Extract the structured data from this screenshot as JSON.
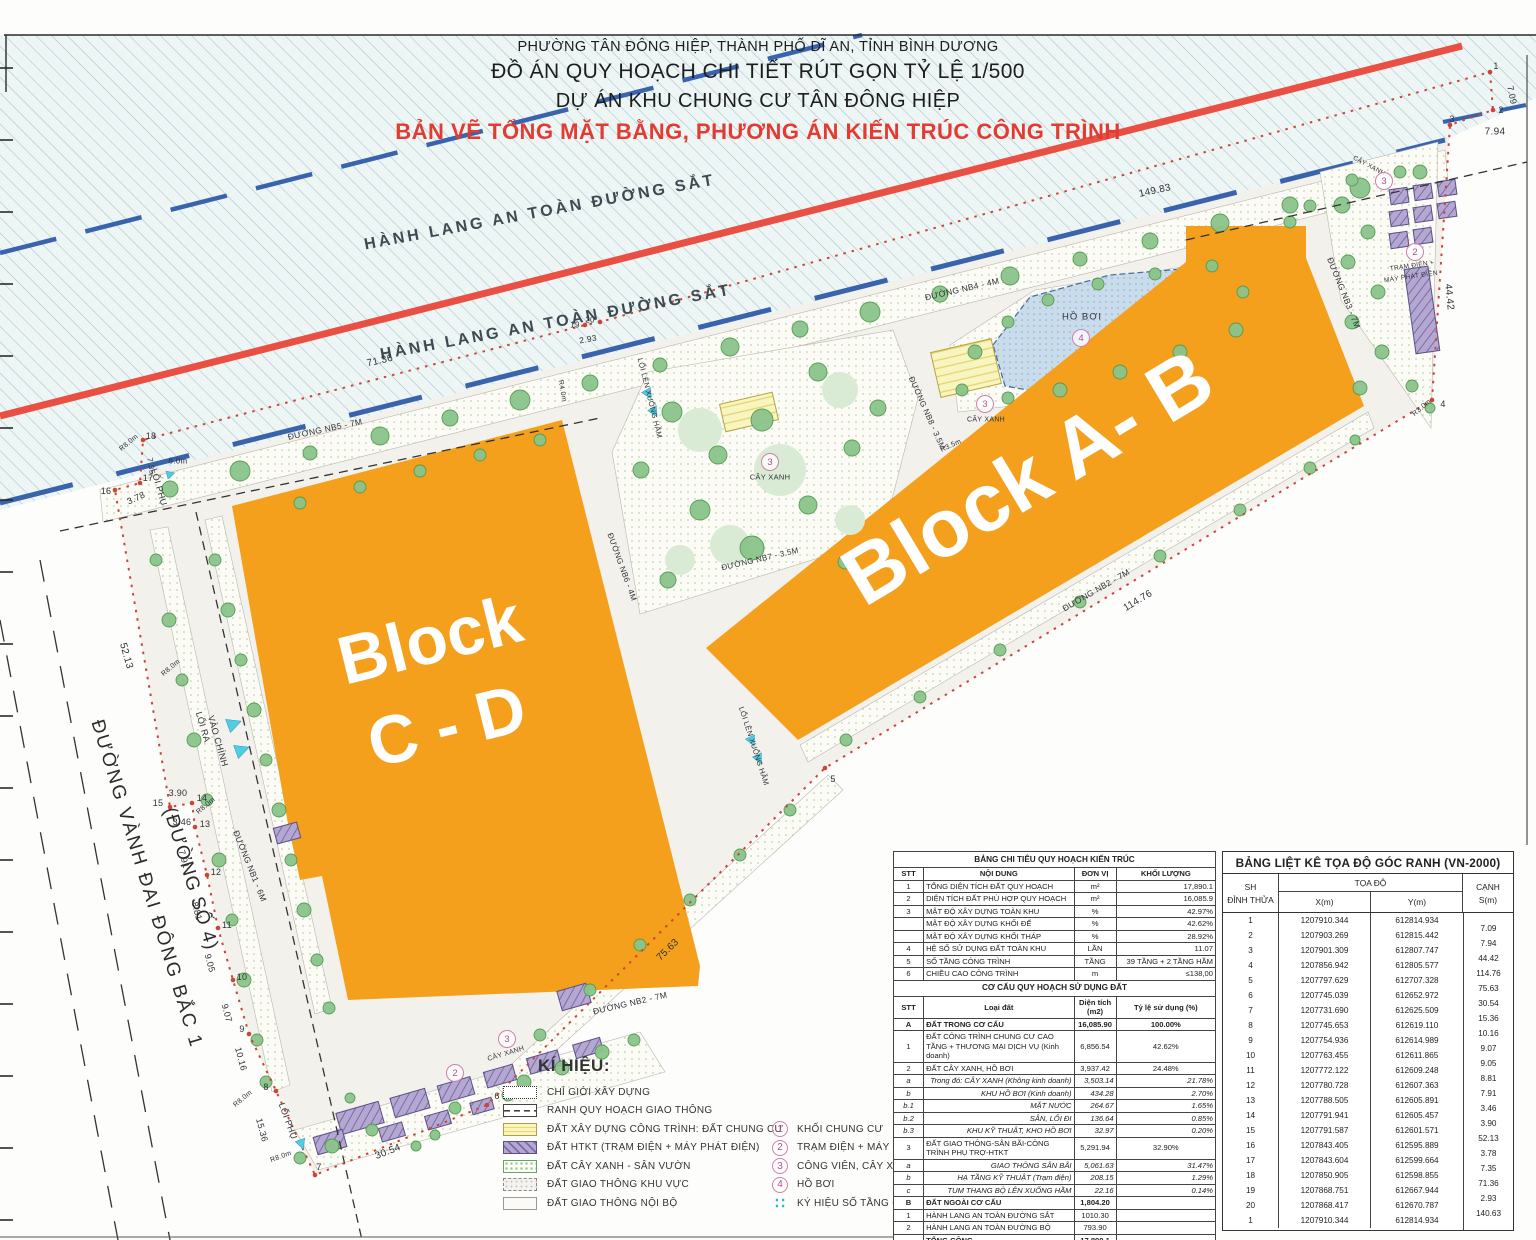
{
  "title": {
    "l1": "PHƯỜNG TÂN ĐÔNG HIỆP, THÀNH PHỐ DĨ AN, TỈNH BÌNH DƯƠNG",
    "l2": "ĐỒ ÁN QUY HOẠCH CHI TIẾT RÚT GỌN TỶ LỆ 1/500",
    "l3": "DỰ ÁN KHU CHUNG CƯ TÂN ĐÔNG HIỆP",
    "l4": "BẢN VẼ TỔNG MẶT BẰNG, PHƯƠNG ÁN KIẾN TRÚC CÔNG TRÌNH"
  },
  "colors": {
    "block_orange": "#F5A01D",
    "railway_red_line": "#E94F43",
    "corridor_blue_dash": "#3A63AE",
    "boundary_red": "#CC4437",
    "pool_blue": "#C6D9EA",
    "htkt_purple": "#A393C6",
    "building_yellow": "#F7F3BB",
    "tree_green": "#86C586",
    "symbol_pink": "#B0509A",
    "arrow_cyan": "#53CBE2",
    "title_red": "#E23B31"
  },
  "plan": {
    "labels": [
      {
        "t": "HÀNH LANG AN TOÀN ĐƯỜNG SẮT",
        "x": 540,
        "y": 213,
        "r": -10.5,
        "s": 16,
        "ls": 3,
        "c": "#3d4a52",
        "w": 600
      },
      {
        "t": "HÀNH LANG AN TOÀN ĐƯỜNG SẮT",
        "x": 556,
        "y": 323,
        "r": -10.5,
        "s": 16,
        "ls": 3,
        "c": "#3d4a52",
        "w": 600
      },
      {
        "t": "Block",
        "x": 430,
        "y": 640,
        "r": -14,
        "s": 68,
        "w": 700,
        "c": "#ffffff"
      },
      {
        "t": "C - D",
        "x": 447,
        "y": 726,
        "r": -14,
        "s": 68,
        "w": 700,
        "c": "#ffffff"
      },
      {
        "t": "Block A- B",
        "x": 1028,
        "y": 478,
        "r": -31,
        "s": 82,
        "w": 700,
        "c": "#ffffff"
      },
      {
        "t": "ĐƯỜNG VÀNH ĐAI ĐÔNG BẮC 1",
        "x": 146,
        "y": 884,
        "r": 73,
        "s": 19,
        "ls": 2,
        "c": "#2c2c2c"
      },
      {
        "t": "(ĐƯỜNG SỐ 4)",
        "x": 190,
        "y": 879,
        "r": 73,
        "s": 19,
        "ls": 1,
        "c": "#2c2c2c"
      },
      {
        "t": "ĐƯỜNG NB5 - 7M",
        "x": 325,
        "y": 429,
        "r": -12,
        "s": 8.5
      },
      {
        "t": "ĐƯỜNG NB4 - 4M",
        "x": 962,
        "y": 289,
        "r": -13,
        "s": 8.5
      },
      {
        "t": "ĐƯỜNG NB3 - 7M",
        "x": 1344,
        "y": 293,
        "r": 68,
        "s": 8.5
      },
      {
        "t": "ĐƯỜNG NB2 - 7M",
        "x": 1096,
        "y": 590,
        "r": -30,
        "s": 8.5
      },
      {
        "t": "ĐƯỜNG NB2 - 7M",
        "x": 630,
        "y": 1003,
        "r": -13,
        "s": 8.5
      },
      {
        "t": "ĐƯỜNG NB1 - 6M",
        "x": 250,
        "y": 866,
        "r": 68,
        "s": 8.5
      },
      {
        "t": "ĐƯỜNG NB8 - 3.5M",
        "x": 927,
        "y": 413,
        "r": 66,
        "s": 8
      },
      {
        "t": "ĐƯỜNG NB7 - 3.5M",
        "x": 760,
        "y": 559,
        "r": -13,
        "s": 8
      },
      {
        "t": "ĐƯỜNG NB6 - 4M",
        "x": 622,
        "y": 567,
        "r": 70,
        "s": 8
      },
      {
        "t": "LỐI RA",
        "x": 203,
        "y": 727,
        "r": 74,
        "s": 9
      },
      {
        "t": "VÀO CHÍNH",
        "x": 218,
        "y": 741,
        "r": 74,
        "s": 9
      },
      {
        "t": "LỐI PHỤ",
        "x": 159,
        "y": 487,
        "r": 74,
        "s": 9
      },
      {
        "t": "LỐI PHỤ",
        "x": 288,
        "y": 1121,
        "r": 70,
        "s": 9
      },
      {
        "t": "LỐI LÊN XUỐNG HẦM",
        "x": 650,
        "y": 398,
        "r": 76,
        "s": 7.5
      },
      {
        "t": "LỐI LÊN XUỐNG HẦM",
        "x": 754,
        "y": 746,
        "r": 72,
        "s": 7.5
      },
      {
        "t": "HỒ BƠI",
        "x": 1082,
        "y": 317,
        "r": 0,
        "s": 9.5,
        "ls": 1
      },
      {
        "t": "CÂY XANH",
        "x": 770,
        "y": 477,
        "r": 0,
        "s": 7.5
      },
      {
        "t": "CÂY XANH",
        "x": 986,
        "y": 420,
        "r": 0,
        "s": 7
      },
      {
        "t": "CÂY XANH",
        "x": 1369,
        "y": 166,
        "r": 28,
        "s": 6.5
      },
      {
        "t": "CÂY XANH",
        "x": 506,
        "y": 1054,
        "r": -17,
        "s": 7
      },
      {
        "t": "TRẠM ĐIỆN +",
        "x": 1412,
        "y": 266,
        "r": -8,
        "s": 6.5
      },
      {
        "t": "MÁY PHÁT ĐIỆN",
        "x": 1411,
        "y": 277,
        "r": -8,
        "s": 6.5
      },
      {
        "t": "149.83",
        "x": 1155,
        "y": 191,
        "r": -12,
        "s": 10
      },
      {
        "t": "7.94",
        "x": 1495,
        "y": 132,
        "r": 0,
        "s": 10
      },
      {
        "t": "7.09",
        "x": 1512,
        "y": 95,
        "r": 78,
        "s": 9
      },
      {
        "t": "44.42",
        "x": 1449,
        "y": 297,
        "r": 84,
        "s": 10
      },
      {
        "t": "114.76",
        "x": 1138,
        "y": 601,
        "r": -31,
        "s": 10
      },
      {
        "t": "75.63",
        "x": 668,
        "y": 950,
        "r": -44,
        "s": 10
      },
      {
        "t": "30.54",
        "x": 388,
        "y": 1152,
        "r": -21,
        "s": 10
      },
      {
        "t": "52.13",
        "x": 126,
        "y": 656,
        "r": 74,
        "s": 10
      },
      {
        "t": "71.36",
        "x": 380,
        "y": 361,
        "r": -13,
        "s": 10
      },
      {
        "t": "2.93",
        "x": 588,
        "y": 339,
        "r": -10,
        "s": 8.5
      },
      {
        "t": "3.78",
        "x": 136,
        "y": 498,
        "r": -25,
        "s": 9
      },
      {
        "t": "7.35",
        "x": 151,
        "y": 466,
        "r": 80,
        "s": 8
      },
      {
        "t": "6.0m",
        "x": 178,
        "y": 461,
        "r": 0,
        "s": 8
      },
      {
        "t": "3.90",
        "x": 178,
        "y": 793,
        "r": 0,
        "s": 9
      },
      {
        "t": "3.46",
        "x": 182,
        "y": 822,
        "r": 0,
        "s": 9
      },
      {
        "t": "7.91",
        "x": 184,
        "y": 859,
        "r": 75,
        "s": 9
      },
      {
        "t": "8.81",
        "x": 197,
        "y": 911,
        "r": 75,
        "s": 9
      },
      {
        "t": "9.05",
        "x": 210,
        "y": 963,
        "r": 75,
        "s": 9
      },
      {
        "t": "9.07",
        "x": 227,
        "y": 1013,
        "r": 75,
        "s": 9
      },
      {
        "t": "10.16",
        "x": 241,
        "y": 1059,
        "r": 75,
        "s": 9
      },
      {
        "t": "15.36",
        "x": 262,
        "y": 1130,
        "r": 75,
        "s": 9
      },
      {
        "t": "R8.0m",
        "x": 129,
        "y": 443,
        "r": -40,
        "s": 7
      },
      {
        "t": "R8.0m",
        "x": 171,
        "y": 668,
        "r": -40,
        "s": 7
      },
      {
        "t": "R8.0m",
        "x": 206,
        "y": 806,
        "r": -40,
        "s": 7
      },
      {
        "t": "R8.0m",
        "x": 243,
        "y": 1099,
        "r": -40,
        "s": 7
      },
      {
        "t": "R8.0m",
        "x": 281,
        "y": 1157,
        "r": -20,
        "s": 7
      },
      {
        "t": "R4.0m",
        "x": 562,
        "y": 391,
        "r": 80,
        "s": 7
      },
      {
        "t": "R3.5m",
        "x": 951,
        "y": 446,
        "r": -25,
        "s": 7
      },
      {
        "t": "R3.0m",
        "x": 1422,
        "y": 408,
        "r": -40,
        "s": 7
      },
      {
        "t": "1",
        "x": 1496,
        "y": 66,
        "r": 0,
        "s": 9
      },
      {
        "t": "2",
        "x": 1501,
        "y": 110,
        "r": 0,
        "s": 9
      },
      {
        "t": "3",
        "x": 1452,
        "y": 119,
        "r": 0,
        "s": 9
      },
      {
        "t": "4",
        "x": 1443,
        "y": 404,
        "r": 0,
        "s": 9
      },
      {
        "t": "5",
        "x": 833,
        "y": 779,
        "r": 0,
        "s": 9
      },
      {
        "t": "6",
        "x": 497,
        "y": 1096,
        "r": 0,
        "s": 9
      },
      {
        "t": "7",
        "x": 319,
        "y": 1167,
        "r": 0,
        "s": 9
      },
      {
        "t": "8",
        "x": 266,
        "y": 1087,
        "r": 0,
        "s": 9
      },
      {
        "t": "9",
        "x": 242,
        "y": 1029,
        "r": 0,
        "s": 9
      },
      {
        "t": "10",
        "x": 242,
        "y": 977,
        "r": 0,
        "s": 9
      },
      {
        "t": "11",
        "x": 227,
        "y": 925,
        "r": 0,
        "s": 9
      },
      {
        "t": "12",
        "x": 216,
        "y": 872,
        "r": 0,
        "s": 9
      },
      {
        "t": "13",
        "x": 205,
        "y": 824,
        "r": 0,
        "s": 9
      },
      {
        "t": "14",
        "x": 202,
        "y": 798,
        "r": 0,
        "s": 9
      },
      {
        "t": "15",
        "x": 158,
        "y": 803,
        "r": 0,
        "s": 9
      },
      {
        "t": "16",
        "x": 106,
        "y": 491,
        "r": 0,
        "s": 9
      },
      {
        "t": "17",
        "x": 148,
        "y": 478,
        "r": 0,
        "s": 9
      },
      {
        "t": "18",
        "x": 151,
        "y": 436,
        "r": 0,
        "s": 9
      },
      {
        "t": "19",
        "x": 575,
        "y": 325,
        "r": 0,
        "s": 8
      },
      {
        "t": "20",
        "x": 590,
        "y": 320,
        "r": 0,
        "s": 8
      }
    ],
    "circles": [
      {
        "n": "4",
        "x": 1081,
        "y": 338
      },
      {
        "n": "3",
        "x": 770,
        "y": 462
      },
      {
        "n": "3",
        "x": 985,
        "y": 404
      },
      {
        "n": "3",
        "x": 1384,
        "y": 181
      },
      {
        "n": "3",
        "x": 507,
        "y": 1039
      },
      {
        "n": "2",
        "x": 1415,
        "y": 252
      },
      {
        "n": "2",
        "x": 455,
        "y": 1073
      }
    ]
  },
  "legend": {
    "title": "KÍ HIỆU:",
    "left": [
      {
        "key": "dotted",
        "label": "CHỈ GIỚI XÂY DỰNG"
      },
      {
        "key": "dash",
        "label": "RANH QUY HOẠCH GIAO THÔNG"
      },
      {
        "key": "yellow",
        "label": "ĐẤT XÂY DỰNG CÔNG TRÌNH: ĐẤT CHUNG CƯ"
      },
      {
        "key": "purple",
        "label": "ĐẤT HTKT (TRẠM ĐIỆN + MÁY PHÁT ĐIỆN)"
      },
      {
        "key": "green",
        "label": "ĐẤT CÂY XANH - SÂN VƯỜN"
      },
      {
        "key": "road1",
        "label": "ĐẤT GIAO THÔNG KHU VỰC"
      },
      {
        "key": "road2",
        "label": "ĐẤT GIAO THÔNG NỘI BỘ"
      }
    ],
    "right": [
      {
        "sym": "1",
        "type": "circle",
        "label": "KHỐI CHUNG CƯ"
      },
      {
        "sym": "2",
        "type": "circle",
        "label": "TRẠM ĐIỆN + MÁY PHÁT ĐIỆN"
      },
      {
        "sym": "3",
        "type": "circle",
        "label": "CÔNG VIÊN, CÂY XANH"
      },
      {
        "sym": "4",
        "type": "circle",
        "label": "HỒ BƠI"
      },
      {
        "sym": "∷",
        "type": "dots",
        "label": "KÝ HIỆU SỐ TẦNG CAO"
      }
    ]
  },
  "tables": {
    "chitieu": {
      "title": "BẢNG CHI TIÊU QUY HOẠCH KIẾN TRÚC",
      "head": [
        "STT",
        "NỘI DUNG",
        "ĐƠN VỊ",
        "KHỐI LƯỢNG"
      ],
      "rows": [
        {
          "stt": "1",
          "c2": "TỔNG DIỆN TÍCH ĐẤT QUY HOẠCH",
          "c3": "m²",
          "c4": "17,890.1"
        },
        {
          "stt": "2",
          "c2": "DIỆN TÍCH ĐẤT PHÙ HỢP QUY HOẠCH",
          "c3": "m²",
          "c4": "16,085.9"
        },
        {
          "stt": "3",
          "c2": "MẬT ĐỘ XÂY DỰNG TOÀN KHU",
          "c3": "%",
          "c4": "42.97%"
        },
        {
          "stt": "",
          "c2": "MẬT ĐỘ XÂY DỰNG KHỐI ĐẾ",
          "c3": "%",
          "c4": "42.62%"
        },
        {
          "stt": "",
          "c2": "MẬT ĐỘ XÂY DỰNG KHỐI THÁP",
          "c3": "%",
          "c4": "28.92%"
        },
        {
          "stt": "4",
          "c2": "HỆ SỐ SỬ DỤNG ĐẤT TOÀN KHU",
          "c3": "LẦN",
          "c4": "11.07"
        },
        {
          "stt": "5",
          "c2": "SỐ TẦNG CÔNG TRÌNH",
          "c3": "TẦNG",
          "c4": "39 TẦNG + 2 TẦNG HẦM"
        },
        {
          "stt": "6",
          "c2": "CHIỀU CAO CÔNG TRÌNH",
          "c3": "m",
          "c4": "≤138,00"
        }
      ],
      "subtitle": "CƠ CẤU QUY HOẠCH SỬ DỤNG ĐẤT",
      "head2": [
        "STT",
        "Loại đất",
        "Diện tích (m2)",
        "Tỷ lệ sử dụng (%)"
      ],
      "rows2": [
        {
          "stt": "A",
          "c2": "ĐẤT TRONG CƠ CẤU",
          "c3": "16,085.90",
          "c4": "100.00%",
          "cls": "b"
        },
        {
          "stt": "1",
          "c2": "ĐẤT CÔNG TRÌNH CHUNG CƯ CAO TẦNG + THƯƠNG MẠI DỊCH VỤ (Kinh doanh)",
          "c3": "6,856.54",
          "c4": "42.62%"
        },
        {
          "stt": "2",
          "c2": "ĐẤT CÂY XANH, HỒ BƠI",
          "c3": "3,937.42",
          "c4": "24.48%"
        },
        {
          "stt": "a",
          "c2": "Trong đó:   CÂY XANH (Không kinh doanh)",
          "c3": "3,503.14",
          "c4": "21.78%",
          "cls": "i"
        },
        {
          "stt": "b",
          "c2": "KHU HỒ BƠI (Kinh doanh)",
          "c3": "434.28",
          "c4": "2.70%",
          "cls": "i"
        },
        {
          "stt": "b.1",
          "c2": "MẶT NƯỚC",
          "c3": "264.67",
          "c4": "1.65%",
          "cls": "i"
        },
        {
          "stt": "b.2",
          "c2": "SÂN, LỐI ĐI",
          "c3": "136.64",
          "c4": "0.85%",
          "cls": "i"
        },
        {
          "stt": "b.3",
          "c2": "KHU KỸ THUẬT, KHO HỒ BƠI",
          "c3": "32.97",
          "c4": "0.20%",
          "cls": "i"
        },
        {
          "stt": "3",
          "c2": "ĐẤT GIAO THÔNG-SÂN BÃI-CÔNG TRÌNH PHỤ TRỢ-HTKT",
          "c3": "5,291.94",
          "c4": "32.90%"
        },
        {
          "stt": "a",
          "c2": "GIAO THÔNG SÂN BÃI",
          "c3": "5,061.63",
          "c4": "31.47%",
          "cls": "i"
        },
        {
          "stt": "b",
          "c2": "HẠ TẦNG KỸ THUẬT (Trạm điện)",
          "c3": "208.15",
          "c4": "1.29%",
          "cls": "i"
        },
        {
          "stt": "c",
          "c2": "TUM THANG BỘ LÊN XUỐNG HẦM",
          "c3": "22.16",
          "c4": "0.14%",
          "cls": "i"
        },
        {
          "stt": "B",
          "c2": "ĐẤT NGOÀI CƠ CẤU",
          "c3": "1,804.20",
          "c4": "",
          "cls": "b"
        },
        {
          "stt": "1",
          "c2": "HÀNH LANG AN TOÀN ĐƯỜNG SẮT",
          "c3": "1010.30",
          "c4": ""
        },
        {
          "stt": "2",
          "c2": "HÀNH LANG AN TOÀN ĐƯỜNG BỘ",
          "c3": "793.90",
          "c4": ""
        },
        {
          "stt": "",
          "c2": "TỔNG CỘNG",
          "c3": "17,890.1",
          "c4": "",
          "cls": "b"
        }
      ]
    },
    "toado": {
      "title": "BẢNG LIỆT KÊ TỌA ĐỘ GÓC RANH (VN-2000)",
      "col_sh1": "SH",
      "col_sh2": "ĐỈNH THỬA",
      "col_toado": "TỌA ĐỘ",
      "col_x": "X(m)",
      "col_y": "Y(m)",
      "col_canh1": "CẠNH",
      "col_canh2": "S(m)",
      "rows": [
        {
          "sh": "1",
          "x": "1207910.344",
          "y": "612814.934"
        },
        {
          "sh": "2",
          "x": "1207903.269",
          "y": "612815.442"
        },
        {
          "sh": "3",
          "x": "1207901.309",
          "y": "612807.747"
        },
        {
          "sh": "4",
          "x": "1207856.942",
          "y": "612805.577"
        },
        {
          "sh": "5",
          "x": "1207797.629",
          "y": "612707.328"
        },
        {
          "sh": "6",
          "x": "1207745.039",
          "y": "612652.972"
        },
        {
          "sh": "7",
          "x": "1207731.690",
          "y": "612625.509"
        },
        {
          "sh": "8",
          "x": "1207745.653",
          "y": "612619.110"
        },
        {
          "sh": "9",
          "x": "1207754.936",
          "y": "612614.989"
        },
        {
          "sh": "10",
          "x": "1207763.455",
          "y": "612611.865"
        },
        {
          "sh": "11",
          "x": "1207772.122",
          "y": "612609.248"
        },
        {
          "sh": "12",
          "x": "1207780.728",
          "y": "612607.363"
        },
        {
          "sh": "13",
          "x": "1207788.505",
          "y": "612605.891"
        },
        {
          "sh": "14",
          "x": "1207791.941",
          "y": "612605.457"
        },
        {
          "sh": "15",
          "x": "1207791.587",
          "y": "612601.571"
        },
        {
          "sh": "16",
          "x": "1207843.405",
          "y": "612595.889"
        },
        {
          "sh": "17",
          "x": "1207843.604",
          "y": "612599.664"
        },
        {
          "sh": "18",
          "x": "1207850.905",
          "y": "612598.855"
        },
        {
          "sh": "19",
          "x": "1207868.751",
          "y": "612667.944"
        },
        {
          "sh": "20",
          "x": "1207868.417",
          "y": "612670.787"
        },
        {
          "sh": "1",
          "x": "1207910.344",
          "y": "612814.934"
        }
      ],
      "s": [
        "7.09",
        "7.94",
        "44.42",
        "114.76",
        "75.63",
        "30.54",
        "15.36",
        "10.16",
        "9.07",
        "9.05",
        "8.81",
        "7.91",
        "3.46",
        "3.90",
        "52.13",
        "3.78",
        "7.35",
        "71.36",
        "2.93",
        "140.63"
      ]
    }
  }
}
